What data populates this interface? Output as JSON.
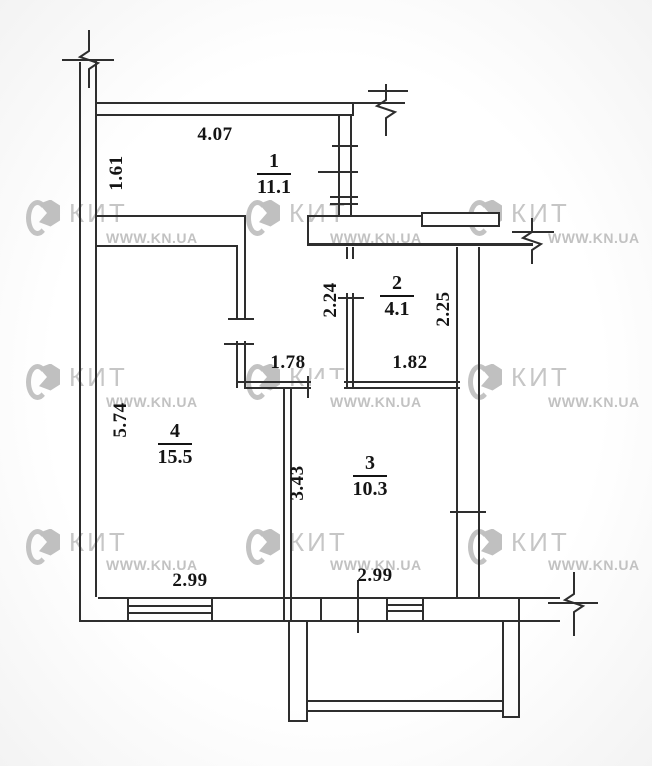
{
  "plan": {
    "title": "apartment floor plan",
    "watermark": {
      "brand": "КИТ",
      "url": "WWW.KN.UA"
    },
    "rooms": [
      {
        "number": "1",
        "area": "11.1"
      },
      {
        "number": "2",
        "area": "4.1"
      },
      {
        "number": "3",
        "area": "10.3"
      },
      {
        "number": "4",
        "area": "15.5"
      }
    ],
    "dimensions": {
      "hall_top_width": "4.07",
      "hall_top_height": "1.61",
      "hall_lower_height": "2.24",
      "bath_height": "2.25",
      "hall_lower_width": "1.78",
      "bath_width": "1.82",
      "living_height": "5.74",
      "kitchen_height": "3.43",
      "living_width": "2.99",
      "kitchen_width": "2.99"
    },
    "colors": {
      "line": "#2e2e2e",
      "dimension_text": "#141414",
      "watermark": "#c6c6c6"
    }
  }
}
